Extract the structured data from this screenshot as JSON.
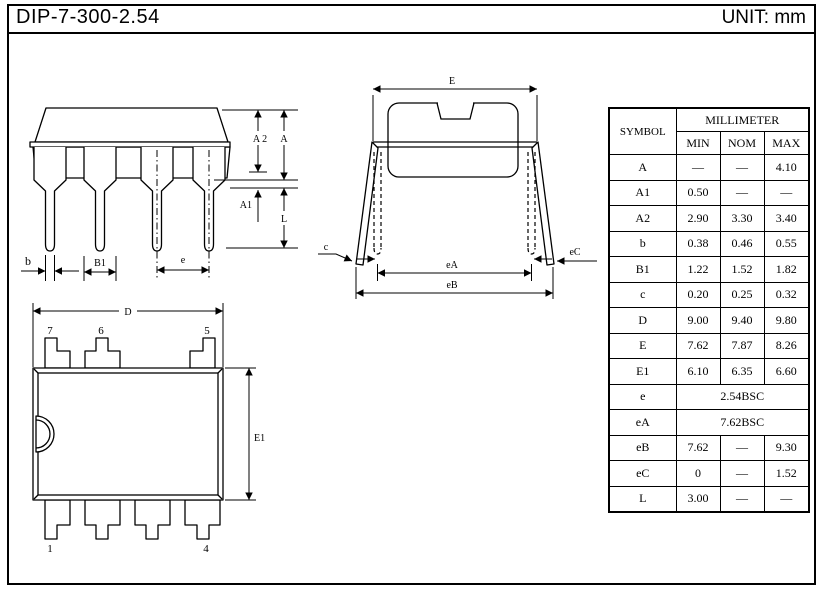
{
  "header": {
    "title": "DIP-7-300-2.54",
    "unit": "UNIT: mm"
  },
  "table": {
    "symbol_header": "SYMBOL",
    "unit_header": "MILLIMETER",
    "col_headers": [
      "MIN",
      "NOM",
      "MAX"
    ],
    "rows": [
      {
        "symbol": "A",
        "min": "—",
        "nom": "—",
        "max": "4.10"
      },
      {
        "symbol": "A1",
        "min": "0.50",
        "nom": "—",
        "max": "—"
      },
      {
        "symbol": "A2",
        "min": "2.90",
        "nom": "3.30",
        "max": "3.40"
      },
      {
        "symbol": "b",
        "min": "0.38",
        "nom": "0.46",
        "max": "0.55"
      },
      {
        "symbol": "B1",
        "min": "1.22",
        "nom": "1.52",
        "max": "1.82"
      },
      {
        "symbol": "c",
        "min": "0.20",
        "nom": "0.25",
        "max": "0.32"
      },
      {
        "symbol": "D",
        "min": "9.00",
        "nom": "9.40",
        "max": "9.80"
      },
      {
        "symbol": "E",
        "min": "7.62",
        "nom": "7.87",
        "max": "8.26"
      },
      {
        "symbol": "E1",
        "min": "6.10",
        "nom": "6.35",
        "max": "6.60"
      },
      {
        "symbol": "e",
        "span": "2.54BSC"
      },
      {
        "symbol": "eA",
        "span": "7.62BSC"
      },
      {
        "symbol": "eB",
        "min": "7.62",
        "nom": "—",
        "max": "9.30"
      },
      {
        "symbol": "eC",
        "min": "0",
        "nom": "—",
        "max": "1.52"
      },
      {
        "symbol": "L",
        "min": "3.00",
        "nom": "—",
        "max": "—"
      }
    ]
  },
  "front_view": {
    "labels": {
      "a2": "A 2",
      "a": "A",
      "a1": "A1",
      "l": "L",
      "b": "b",
      "b1": "B1",
      "e": "e"
    }
  },
  "side_view": {
    "labels": {
      "e": "E",
      "ea": "eA",
      "eb": "eB",
      "c": "c",
      "ec": "eC"
    }
  },
  "top_view": {
    "labels": {
      "d": "D",
      "e1": "E1",
      "pin7": "7",
      "pin6": "6",
      "pin5": "5",
      "pin1": "1",
      "pin4": "4"
    }
  },
  "colors": {
    "ink": "#000000",
    "paper": "#ffffff"
  }
}
